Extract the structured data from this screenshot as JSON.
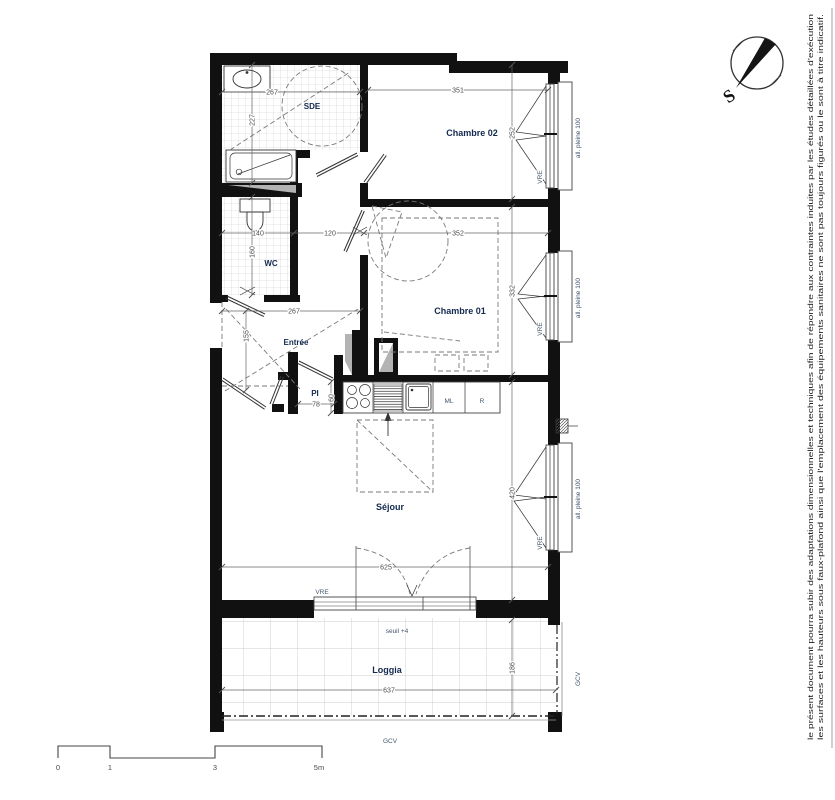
{
  "plan": {
    "rooms": {
      "sde": "SDE",
      "chambre02": "Chambre 02",
      "wc": "WC",
      "chambre01": "Chambre 01",
      "entree": "Entrée",
      "pi": "PI",
      "sejour": "Séjour",
      "loggia": "Loggia"
    },
    "appliances": {
      "ml": "ML",
      "r": "R"
    },
    "labels": {
      "vre": "VRE",
      "allege": "all. pleine 100",
      "gcv": "GCV",
      "seuil": "seuil +4"
    },
    "dims": {
      "sde_w": "267",
      "sde_h": "227",
      "ch02_w": "351",
      "ch02_h": "252",
      "wc_w": "140",
      "wc_h": "160",
      "hall_w": "120",
      "ch01_w": "352",
      "ch01_h": "332",
      "entree_w": "267",
      "entree_h": "155",
      "pi_w": "78",
      "pi_d": "60",
      "sejour_w": "625",
      "sejour_h": "420",
      "loggia_w": "637",
      "loggia_h": "186"
    }
  },
  "compass": {
    "south": "S"
  },
  "scale_bar": {
    "t0": "0",
    "t1": "1",
    "t3": "3",
    "t5": "5m"
  },
  "disclaimer": {
    "line1": "le présent document pourra subir des adaptations dimensionnelles et techniques afin de répondre aux contraintes induites par les études détaillées d'exécution",
    "line2": "les surfaces et les hauteurs sous faux-plafond ainsi que l'emplacement des équipements sanitaires ne sont pas toujours figurés ou le sont à titre indicatif."
  },
  "colors": {
    "wall": "#111111",
    "room_label": "#13294d",
    "sde_label": "#a8611c",
    "dimension": "#4a4a4a",
    "technical": "#44566e"
  }
}
